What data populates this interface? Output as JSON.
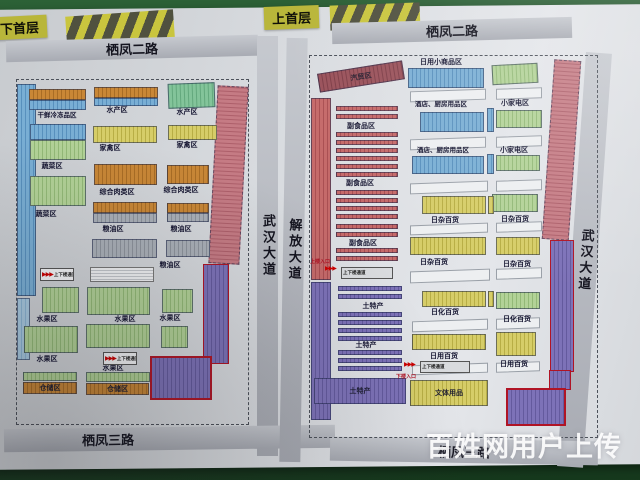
{
  "floor_badges": {
    "left": "下首层",
    "right": "上首层"
  },
  "watermark": "百姓网用户上传",
  "left_map": {
    "road_top": "栖凤二路",
    "road_right": "武汉大道",
    "road_bottom": "栖凤三路",
    "zones": [
      "干鲜冷冻品区",
      "水产区",
      "水产区",
      "蔬菜区",
      "家禽区",
      "家禽区",
      "蔬菜区",
      "综合肉类区",
      "综合肉类区",
      "粮油区",
      "粮油区",
      "粮油区",
      "水果区",
      "水果区",
      "水果区",
      "水果区",
      "水果区",
      "仓储区",
      "仓储区"
    ],
    "passages": [
      "上下楼通道",
      "上下楼通道"
    ]
  },
  "right_map": {
    "road_top": "栖凤二路",
    "road_left": "解放大道",
    "road_right": "武汉大道",
    "road_bottom": "栖凤三路",
    "zones": [
      "日用小商品区",
      "汽贸区",
      "副食品区",
      "副食品区",
      "副食品区",
      "酒店、厨房用品区",
      "酒店、厨房用品区",
      "小家电区",
      "小家电区",
      "日杂百货",
      "日杂百货",
      "日杂百货",
      "日杂百货",
      "日化百货",
      "日化百货",
      "日用百货",
      "日用百货",
      "土特产",
      "土特产",
      "土特产",
      "文体用品"
    ],
    "passages": [
      "上楼入口",
      "上下楼通道",
      "下楼入口",
      "上下楼通道"
    ]
  },
  "palette": {
    "board": "#d8dbdf",
    "frame_green": "#27572f",
    "road_gray": "#b3b6bd",
    "badge_yellow": "#b9b63a",
    "zone_blue": "#6ba3cd",
    "zone_orange": "#c07c2e",
    "zone_yellow": "#cfc65c",
    "zone_green": "#a5c98b",
    "zone_gray": "#9fa5ad",
    "zone_pink": "#bd6f7a",
    "zone_purple": "#7168ad",
    "accent_red": "#b01425"
  }
}
